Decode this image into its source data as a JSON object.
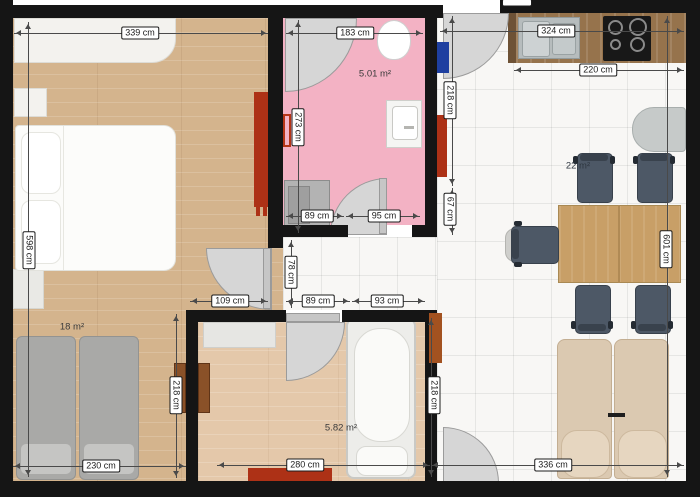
{
  "plan_title": "Apartment floor plan",
  "rooms": {
    "bedroom": {
      "area": "18 m²"
    },
    "bathroom_top": {
      "area": "5.01 m²"
    },
    "bathroom_bottom": {
      "area": "5.82 m²"
    },
    "living_kitchen": {
      "area": "22 m²"
    }
  },
  "dims": {
    "bedroom_width": "339 cm",
    "bathroom_top_width": "183 cm",
    "living_width": "324 cm",
    "kitchen_counter": "220 cm",
    "bedroom_height": "598 cm",
    "bathroom_top_height": "273 cm",
    "entry_wall": "218 cm",
    "entry_wall_lower": "67 cm",
    "bathroom_top_wall_segment": "89 cm",
    "bathroom_top_door": "95 cm",
    "living_height": "601 cm",
    "living_bottom_width": "336 cm",
    "bedroom_bottom_width": "230 cm",
    "bedroom_right_height": "218 cm",
    "bedroom_door_nook": "109 cm",
    "hall_width": "78 cm",
    "hall_segment_a": "89 cm",
    "hall_segment_b": "93 cm",
    "bathroom_bottom_height": "218 cm",
    "bathroom_bottom_width": "280 cm"
  },
  "colors": {
    "wall": "#151515",
    "bedroom_floor": "#d4b48d",
    "bathroom_bottom_floor": "#e4c8aa",
    "tile_floor": "#f8f7f5",
    "bathroom_top_floor": "#f3b2c4",
    "radiator_red": "#ad3116",
    "radiator_orange": "#a35220",
    "cabinet_brown": "#8a5128",
    "electrical_panel_blue": "#1e3fa0",
    "chair_gray": "#4d5866",
    "sofa_beige": "#dbc9b1",
    "table_wood": "#c89f67",
    "counter_wood": "#96734c",
    "door_swing_gray": "#d6d6d6"
  }
}
